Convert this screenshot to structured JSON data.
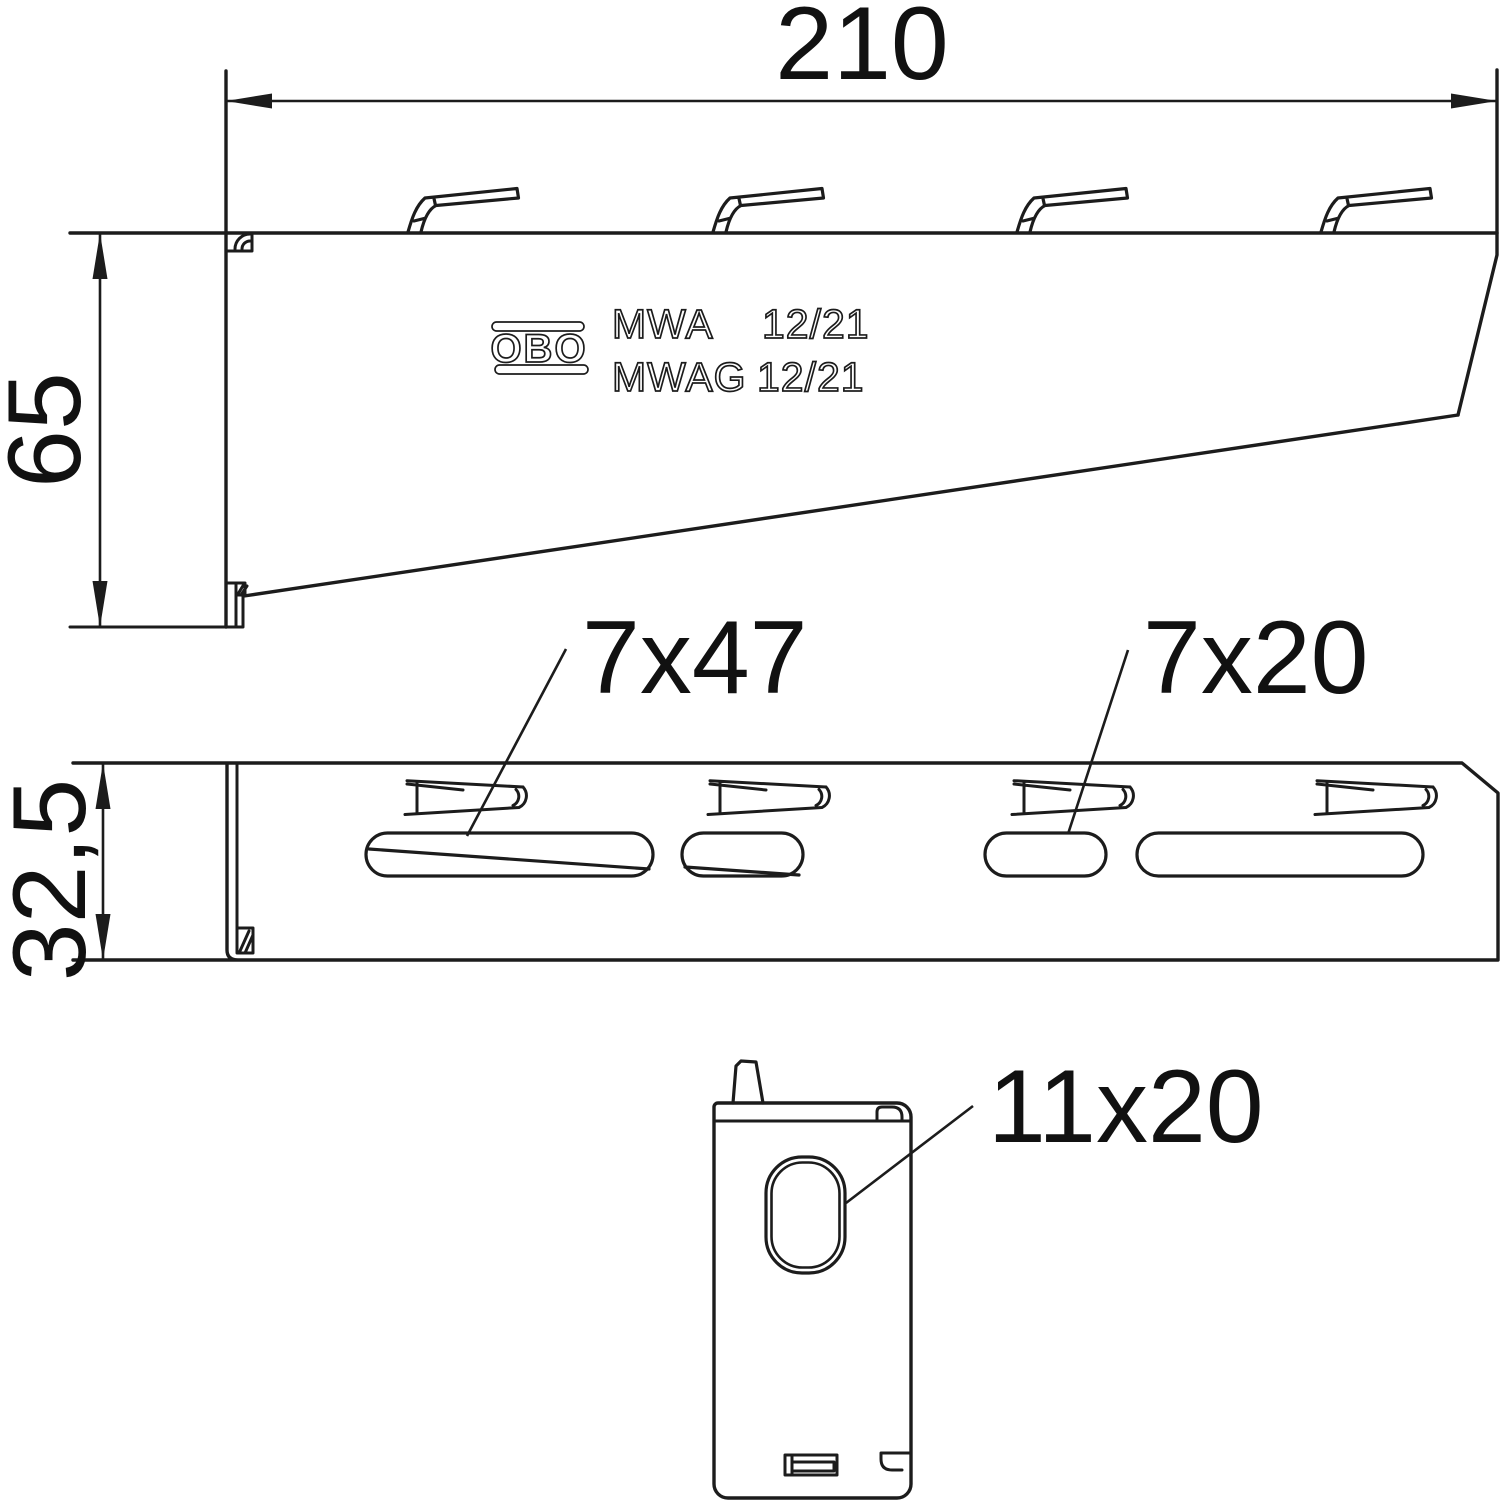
{
  "colors": {
    "background": "#ffffff",
    "line": "#1c1c1c",
    "text": "#111111"
  },
  "dimensions": {
    "width": "210",
    "height": "65",
    "depth": "32,5"
  },
  "labels": {
    "slot_long": "7x47",
    "slot_short": "7x20",
    "end_hole": "11x20"
  },
  "marking": {
    "brand": "OBO",
    "row1_model": "MWA",
    "row1_type": "12/21",
    "row2_model": "MWAG",
    "row2_type": "12/21"
  }
}
